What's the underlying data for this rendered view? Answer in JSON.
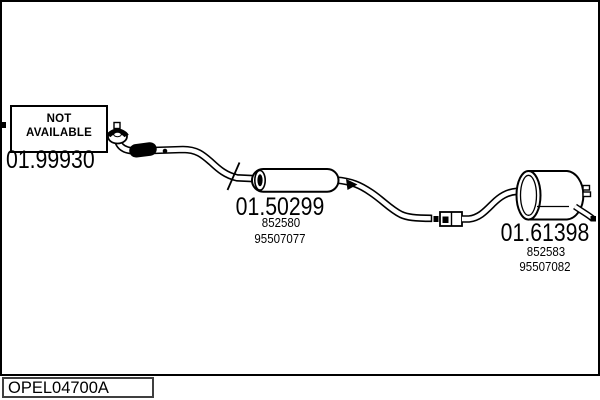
{
  "colors": {
    "background": "#ffffff",
    "line": "#000000",
    "frame_border": "#000000",
    "footer_box_border": "#3f3f3f"
  },
  "not_available_box": {
    "line1": "NOT",
    "line2": "AVAILABLE"
  },
  "parts": {
    "front_pipe": {
      "code": "01.99930"
    },
    "center_muffler": {
      "code": "01.50299",
      "oe_ref": "852580",
      "part_ref": "95507077"
    },
    "rear_muffler": {
      "code": "01.61398",
      "oe_ref": "852583",
      "part_ref": "95507082"
    }
  },
  "footer": {
    "diagram_code": "OPEL04700A"
  }
}
